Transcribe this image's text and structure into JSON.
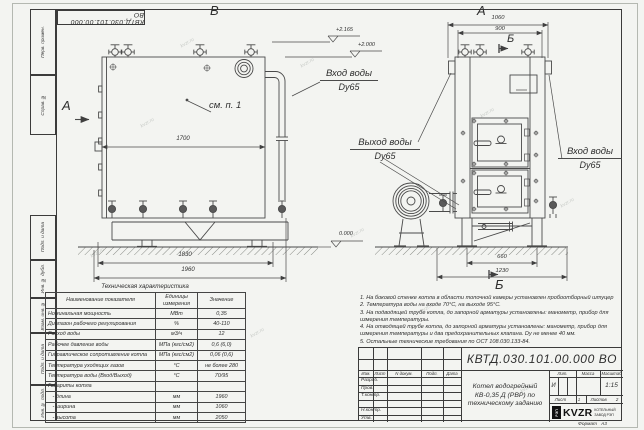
{
  "sheet": {
    "stamp_top": "КВТД.030.101.00.000 ВО",
    "format_label": "Формат",
    "format_value": "А3",
    "frame_labels": [
      "Перв. примен.",
      "Справ. №",
      "Подп. и дата",
      "Инв. № дубл.",
      "Взам. инв. №",
      "Подп. и дата",
      "Инв. № подл."
    ],
    "watermark": "kvzr.ru"
  },
  "views": {
    "left_view_label": "В",
    "right_view_label": "А",
    "section_a_label": "А",
    "section_b_top": "Б",
    "section_b_bottom": "Б",
    "note_ref": "см. п. 1",
    "dims": {
      "body_length": "1700",
      "support_span": "1830",
      "total_length": "1960",
      "front_width": "1060",
      "front_inner": "900",
      "base_inner": "660",
      "base_outer": "1230"
    },
    "elevations": {
      "valve_top": "+2.165",
      "boiler_top": "+2.000",
      "ground": "0.000"
    },
    "port_labels": {
      "inlet_top_1": "Вход воды",
      "inlet_top_2": "Dy65",
      "outlet_1": "Выход воды",
      "outlet_2": "Dy65",
      "inlet_right_1": "Вход воды",
      "inlet_right_2": "Dy65"
    }
  },
  "spec_table": {
    "title": "Техническая характеристика",
    "headers": [
      "Наименование показателя",
      "Единицы измерения",
      "Значение"
    ],
    "rows": [
      [
        "Номинальная мощность",
        "МВт",
        "0,35"
      ],
      [
        "Диапазон рабочего регулирования",
        "%",
        "40-110"
      ],
      [
        "Расход воды",
        "м3/ч",
        "12"
      ],
      [
        "Рабочее давление воды",
        "МПа (кгс/см2)",
        "0,6 (6,0)"
      ],
      [
        "Гидравлическое сопротивление котла",
        "МПа (кгс/см2)",
        "0,06 (0,6)"
      ],
      [
        "Температура уходящих газов",
        "°С",
        "не более 280"
      ],
      [
        "Температура воды (Вход/Выход)",
        "°С",
        "70/95"
      ],
      [
        "Габариты котла",
        "",
        ""
      ],
      [
        "   - длина",
        "мм",
        "1960"
      ],
      [
        "   - ширина",
        "мм",
        "1060"
      ],
      [
        "   - высота",
        "мм",
        "2050"
      ]
    ]
  },
  "notes": [
    "1. На боковой стенке котла в области топочной камеры установлен пробоотборный штуцер",
    "2. Температура воды на входе 70°С, на выходе 95°С.",
    "3. На подводящей трубе котла, до запорной арматуры установлены: манометр, прибор для измерения температуры.",
    "4. На отводящей трубе котла, до запорной арматуры установлены: манометр, прибор для измерения температуры и два предохранительных клапана. Dу не менее 40 мм.",
    "5. Остальные технические требования по ОСТ 108.030.133-84."
  ],
  "title_block": {
    "designation": "КВТД.030.101.00.000 ВО",
    "doc_name": [
      "Котел водогрейный",
      "КВ-0,35 Д (РВР) по",
      "техническому заданию"
    ],
    "header_cols": [
      "Изм.",
      "Лист",
      "N докум.",
      "Подп.",
      "Дата"
    ],
    "sign_rows": [
      "Разраб.",
      "Пров.",
      "Т.контр.",
      " ",
      "Н.контр.",
      "Утв."
    ],
    "lit_label": "Лит.",
    "mass_label": "Масса",
    "scale_label": "Масштаб",
    "lit_value": "И",
    "scale_value": "1:15",
    "sheet_label": "Лист",
    "sheet_value": "1",
    "sheets_label": "Листов",
    "sheets_value": "2",
    "logo_text": "KVZR",
    "logo_vert": "РЭП",
    "logo_lines": [
      "КОТЕЛЬНЫЙ",
      "ЗАВОД РЭП"
    ]
  }
}
